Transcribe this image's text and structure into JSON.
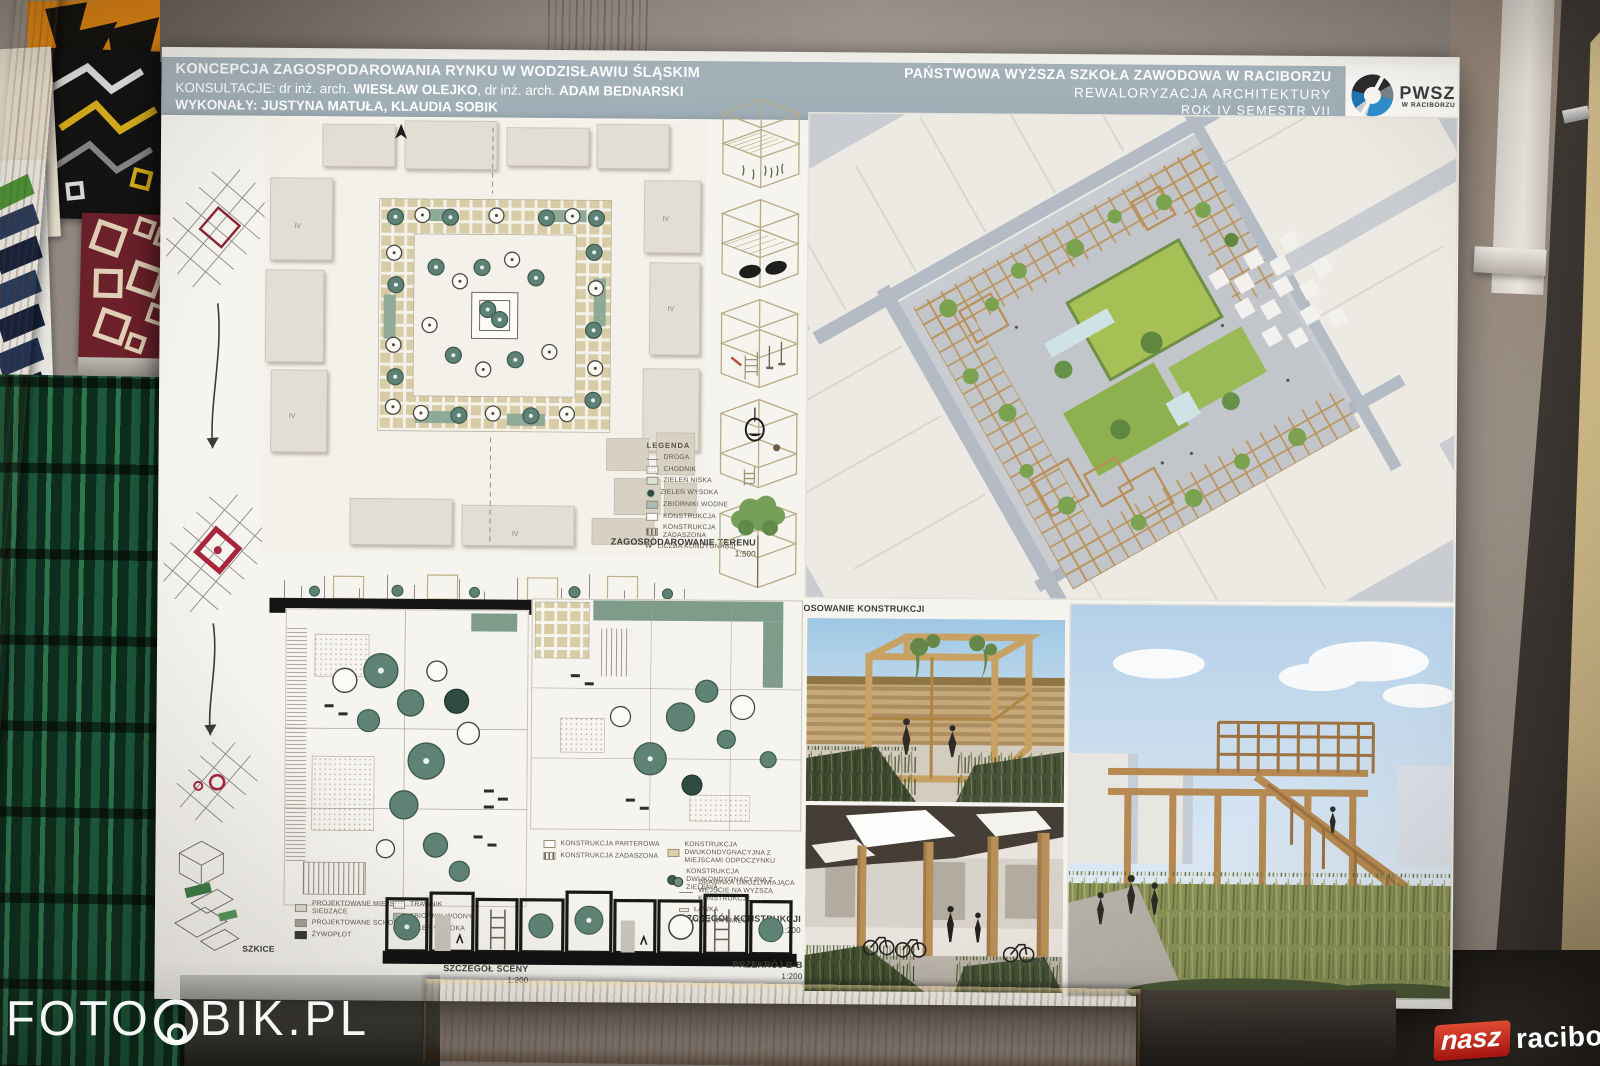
{
  "photo": {
    "watermark_left": {
      "part1": "FOTO",
      "part2": "BIK.PL"
    },
    "watermark_right": {
      "badge": "nasz",
      "site": "raciborz",
      "dot": ".",
      "tld": "pl"
    }
  },
  "poster": {
    "header": {
      "title": "KONCEPCJA ZAGOSPODAROWANIA RYNKU W WODZISŁAWIU ŚLĄSKIM",
      "consult_prefix": "KONSULTACJE: dr inż. arch. ",
      "consult_name1": "WIESŁAW OLEJKO",
      "consult_mid": ", dr inż. arch. ",
      "consult_name2": "ADAM BEDNARSKI",
      "authors_prefix": "WYKONAŁY: ",
      "authors_names": "JUSTYNA MATUŁA, KLAUDIA SOBIK",
      "school": "PAŃSTWOWA WYŻSZA SZKOŁA ZAWODOWA W RACIBORZU",
      "course": "REWALORYZACJA ARCHITEKTURY",
      "term": "ROK IV SEMESTR VII",
      "logo_name": "PWSZ",
      "logo_sub": "W RACIBORZU"
    },
    "labels": {
      "site_plan": "ZAGOSPODAROWANIE TERENU",
      "site_plan_scale": "1:500",
      "section_aa": "PRZEKRÓJ A-A",
      "section_aa_scale": "1:500",
      "construction_use": "ZASTOSOWANIE KONSTRUKCJI",
      "scene_detail": "SZCZEGÓŁ SCENY",
      "scene_detail_scale": "1:200",
      "construction_detail": "SZCZEGÓŁ KONSTRUKCJI",
      "construction_detail_scale": "1:200",
      "section_bb": "PRZEKRÓJ B-B",
      "section_bb_scale": "1:200",
      "sketches": "SZKICE",
      "storey_mark": "IV"
    },
    "legend_site": {
      "title": "LEGENDA",
      "items": [
        "DROGA",
        "CHODNIK",
        "ZIELEŃ NISKA",
        "ZIELEŃ WYSOKA",
        "ZBIORNIKI WODNE",
        "KONSTRUKCJA",
        "KONSTRUKCJA ZADASZONA",
        "LICZBA KONDYGNACJI"
      ]
    },
    "legend_scene": {
      "items": [
        "PROJEKTOWANE MIEJSCA SIEDZĄCE",
        "PROJEKTOWANE SCHODY",
        "ŻYWOPŁOT",
        "TRAWNIK",
        "ZBIORNIK WODNY",
        "ZIELEŃ WYSOKA"
      ]
    },
    "legend_construction": {
      "items": [
        "KONSTRUKCJA PARTEROWA",
        "KONSTRUKCJA ZADASZONA",
        "KONSTRUKCJA DWUKONDYGNACYJNA Z MIEJSCAMI ODPOCZYNKU",
        "KONSTRUKCJA DWUKONDYGNACYJNA Z ZIELENIĄ",
        "DRABINKA UMOŻLIWIAJĄCA WEJŚCIE NA WYŻSZĄ KONSTRUKCJĘ",
        "ŁAWKA",
        "KOSZ NA ŚMIECI"
      ]
    },
    "colors": {
      "header_band": "#a2b0b8",
      "logo_blue": "#2e8fd0",
      "tree_teal": "#5d8174",
      "wood": "#c49a5e",
      "badge_red": "#c22a1e",
      "sketch_red": "#a8263b"
    }
  }
}
